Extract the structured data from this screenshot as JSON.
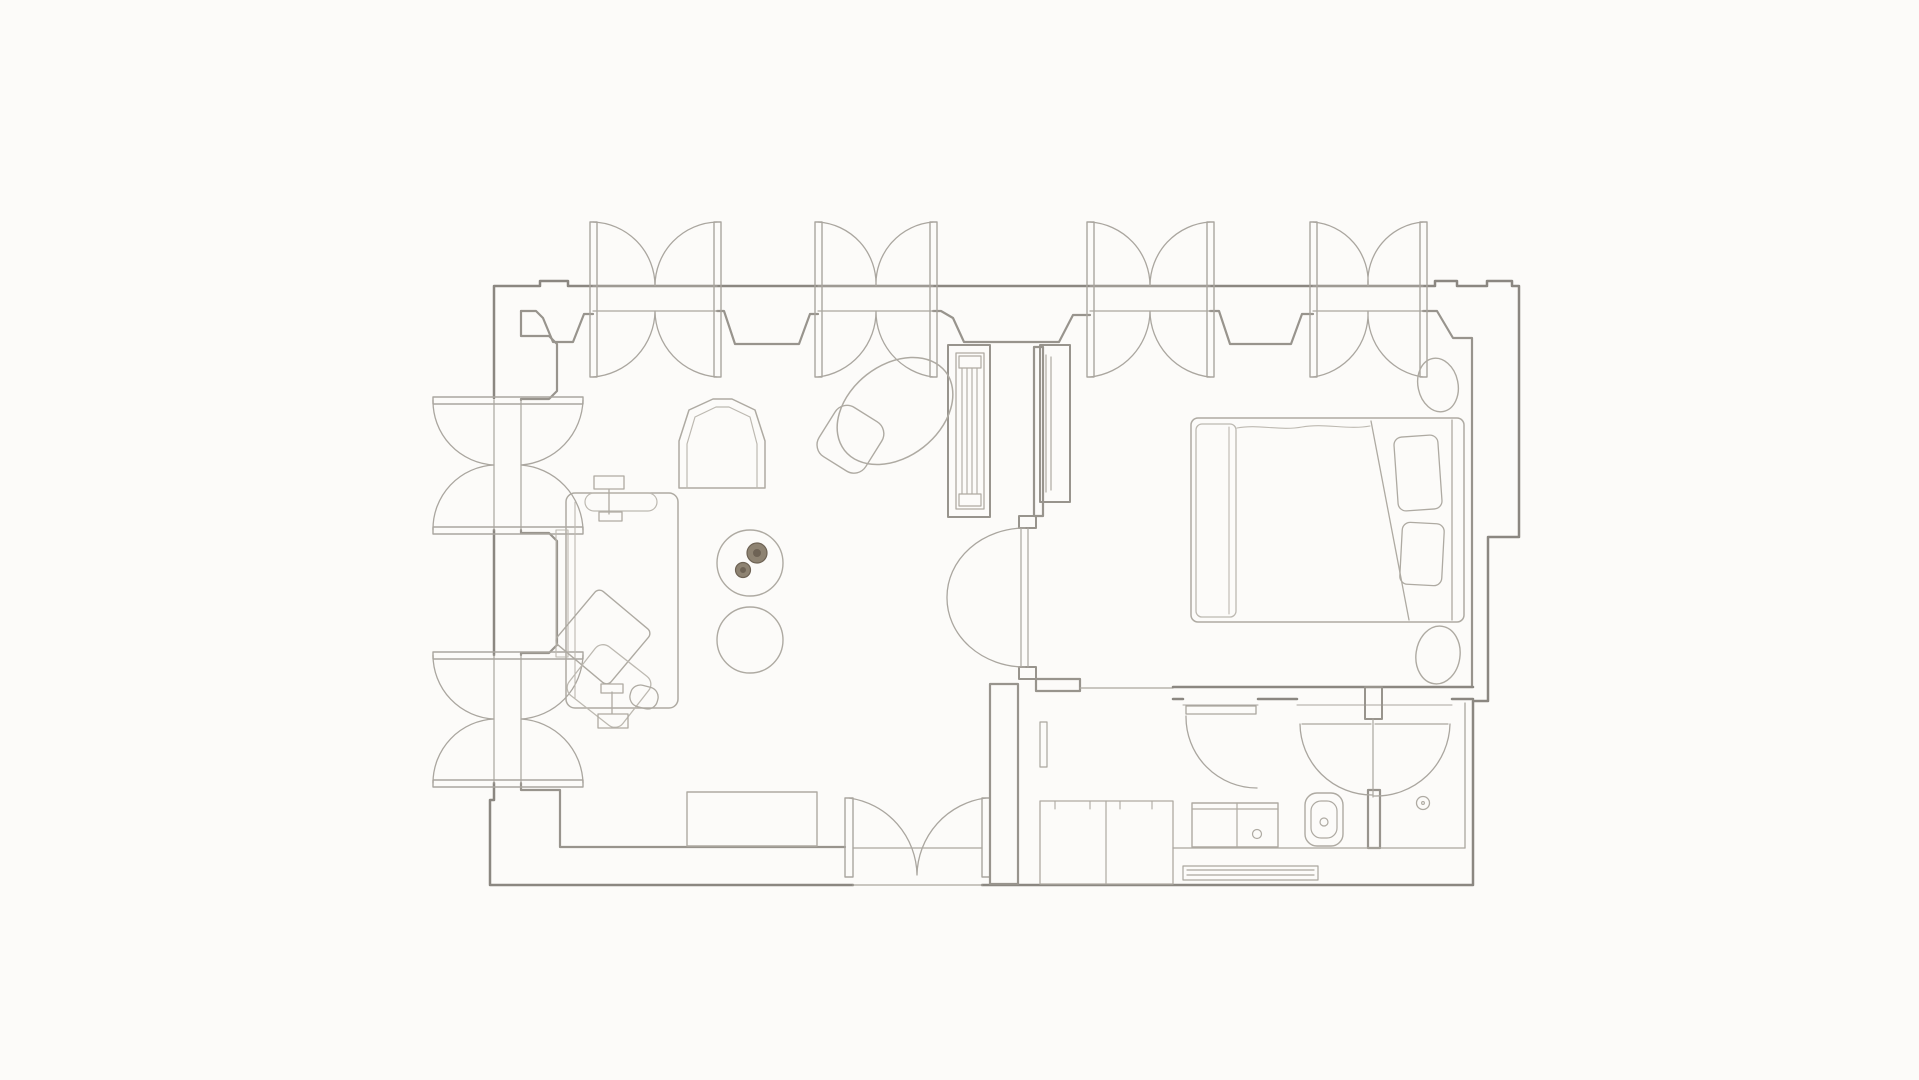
{
  "canvas": {
    "width": 1919,
    "height": 1080,
    "background": "#fcfbf9"
  },
  "palette": {
    "wall": "#8b8781",
    "wall_mid": "#98948d",
    "wall_light": "#aaa69f",
    "furniture": "#aeaaa2",
    "furniture_light": "#bdb9b1",
    "flower_fill": "#8e8372",
    "flower_dark": "#6e6355",
    "white": "#fcfbf9"
  },
  "shapes": [
    {
      "n": "outer-wall",
      "t": "path",
      "d": "M 494,398 V 286 H 540 V 281 H 568 V 286 H 1435 V 281 H 1457 V 286 H 1487 V 281 H 1512 V 286 H 1519 V 537 H 1488 V 701 H 1473 V 885 H 982 M 853,885 H 490 V 800 H 494 V 783 M 494,530 V 655",
      "s": "wall",
      "w": 2.5
    },
    {
      "n": "inner-wall-top",
      "t": "path",
      "d": "M 521,311 H 536 L 543,318 L 553,342 H 573 L 584,314 H 593 M 717,311 H 724 L 735,344 H 799 L 810,314 H 818 M 933,311 H 941 L 953,318 L 964,342 H 1059 L 1073,315 H 1090 M 1210,311 H 1219 L 1230,344 H 1291 L 1302,314 H 1313 M 1423,311 H 1437 L 1453,338 H 1472 V 687",
      "s": "wall_mid",
      "w": 2.2
    },
    {
      "n": "inner-wall-left",
      "t": "path",
      "d": "M 521,311 V 336 H 549 L 557,344 V 391 L 549,399 H 521 V 400 M 521,530 V 533 H 549 L 557,541 V 645 L 549,653 H 521 V 655",
      "s": "wall_mid",
      "w": 2.2
    },
    {
      "n": "inner-wall-bottom",
      "t": "path",
      "d": "M 521,783 V 790 H 560 V 847 H 845",
      "s": "wall_mid",
      "w": 2.2
    },
    {
      "n": "threshold-outer-line",
      "t": "path",
      "d": "M 853,885 H 982",
      "s": "wall_light",
      "w": 1.3
    },
    {
      "n": "threshold-inner-line",
      "t": "path",
      "d": "M 853,848 H 982",
      "s": "wall_light",
      "w": 1.3
    },
    {
      "n": "window-1-leaf-left",
      "t": "rect",
      "x": 590,
      "y": 222,
      "w2": 7,
      "h": 155,
      "s": "wall_light",
      "w": 1.4
    },
    {
      "n": "window-1-leaf-right",
      "t": "rect",
      "x": 714,
      "y": 222,
      "w2": 7,
      "h": 155,
      "s": "wall_light",
      "w": 1.4
    },
    {
      "n": "window-1-glazing",
      "t": "path",
      "d": "M 593,286 H 717 M 593,311 H 717",
      "s": "wall_light",
      "w": 1.2
    },
    {
      "n": "window-1-swing-arcs",
      "t": "path",
      "d": "M 593,222 A 64 64 0 0 1 655,286 M 717,222 A 64 64 0 0 0 655,286 M 593,377 A 67 67 0 0 0 655,311 M 717,377 A 67 67 0 0 1 655,311",
      "s": "wall_light",
      "w": 1.3
    },
    {
      "n": "window-2-leaf-left",
      "t": "rect",
      "x": 815,
      "y": 222,
      "w2": 7,
      "h": 155,
      "s": "wall_light",
      "w": 1.4
    },
    {
      "n": "window-2-leaf-right",
      "t": "rect",
      "x": 930,
      "y": 222,
      "w2": 7,
      "h": 155,
      "s": "wall_light",
      "w": 1.4
    },
    {
      "n": "window-2-glazing",
      "t": "path",
      "d": "M 818,286 H 933 M 818,311 H 933",
      "s": "wall_light",
      "w": 1.2
    },
    {
      "n": "window-2-swing-arcs",
      "t": "path",
      "d": "M 818,222 A 62 62 0 0 1 876,286 M 933,222 A 62 62 0 0 0 876,286 M 818,377 A 66 66 0 0 0 876,311 M 933,377 A 66 66 0 0 1 876,311",
      "s": "wall_light",
      "w": 1.3
    },
    {
      "n": "window-3-leaf-left",
      "t": "rect",
      "x": 1087,
      "y": 222,
      "w2": 7,
      "h": 155,
      "s": "wall_light",
      "w": 1.4
    },
    {
      "n": "window-3-leaf-right",
      "t": "rect",
      "x": 1207,
      "y": 222,
      "w2": 7,
      "h": 155,
      "s": "wall_light",
      "w": 1.4
    },
    {
      "n": "window-3-glazing",
      "t": "path",
      "d": "M 1090,286 H 1210 M 1090,311 H 1210",
      "s": "wall_light",
      "w": 1.2
    },
    {
      "n": "window-3-swing-arcs",
      "t": "path",
      "d": "M 1090,222 A 64 64 0 0 1 1150,286 M 1210,222 A 64 64 0 0 0 1150,286 M 1090,377 A 67 67 0 0 0 1150,311 M 1210,377 A 67 67 0 0 1 1150,311",
      "s": "wall_light",
      "w": 1.3
    },
    {
      "n": "window-4-leaf-left",
      "t": "rect",
      "x": 1310,
      "y": 222,
      "w2": 7,
      "h": 155,
      "s": "wall_light",
      "w": 1.4
    },
    {
      "n": "window-4-leaf-right",
      "t": "rect",
      "x": 1420,
      "y": 222,
      "w2": 7,
      "h": 155,
      "s": "wall_light",
      "w": 1.4
    },
    {
      "n": "window-4-glazing",
      "t": "path",
      "d": "M 1313,286 H 1423 M 1313,311 H 1423",
      "s": "wall_light",
      "w": 1.2
    },
    {
      "n": "window-4-swing-arcs",
      "t": "path",
      "d": "M 1313,222 A 60 60 0 0 1 1368,286 M 1423,222 A 60 60 0 0 0 1368,286 M 1313,377 A 64 64 0 0 0 1368,311 M 1423,377 A 64 64 0 0 1 1368,311",
      "s": "wall_light",
      "w": 1.3
    },
    {
      "n": "left-window-1-leaf-top",
      "t": "rect",
      "x": 433,
      "y": 397,
      "w2": 150,
      "h": 7,
      "s": "wall_light",
      "w": 1.4
    },
    {
      "n": "left-window-1-leaf-bottom",
      "t": "rect",
      "x": 433,
      "y": 527,
      "w2": 150,
      "h": 7,
      "s": "wall_light",
      "w": 1.4
    },
    {
      "n": "left-window-1-glazing",
      "t": "path",
      "d": "M 494,400 V 530 M 521,400 V 530",
      "s": "wall_light",
      "w": 1.2
    },
    {
      "n": "left-window-1-swing-arcs",
      "t": "path",
      "d": "M 433,400 A 64 64 0 0 0 494,465 M 433,530 A 64 64 0 0 1 494,465 M 583,400 A 67 67 0 0 1 521,465 M 583,530 A 67 67 0 0 0 521,465",
      "s": "wall_light",
      "w": 1.3
    },
    {
      "n": "left-window-2-leaf-top",
      "t": "rect",
      "x": 433,
      "y": 652,
      "w2": 150,
      "h": 7,
      "s": "wall_light",
      "w": 1.4
    },
    {
      "n": "left-window-2-leaf-bottom",
      "t": "rect",
      "x": 433,
      "y": 780,
      "w2": 150,
      "h": 7,
      "s": "wall_light",
      "w": 1.4
    },
    {
      "n": "left-window-2-glazing",
      "t": "path",
      "d": "M 494,655 V 783 M 521,655 V 783",
      "s": "wall_light",
      "w": 1.2
    },
    {
      "n": "left-window-2-swing-arcs",
      "t": "path",
      "d": "M 433,655 A 64 64 0 0 0 494,719 M 433,783 A 64 64 0 0 1 494,719 M 583,655 A 66 66 0 0 1 521,719 M 583,783 A 66 66 0 0 0 521,719",
      "s": "wall_light",
      "w": 1.3
    },
    {
      "n": "entry-door-leaf-left",
      "t": "rect",
      "x": 845,
      "y": 798,
      "w2": 8,
      "h": 79,
      "s": "wall_light",
      "w": 1.4
    },
    {
      "n": "entry-door-leaf-right",
      "t": "rect",
      "x": 982,
      "y": 798,
      "w2": 8,
      "h": 79,
      "s": "wall_light",
      "w": 1.4
    },
    {
      "n": "entry-door-swing-arcs",
      "t": "path",
      "d": "M 849,798 A 79 79 0 0 1 917,875 M 986,798 A 79 79 0 0 0 917,875",
      "s": "wall_light",
      "w": 1.3
    },
    {
      "n": "partition-wall-stem",
      "t": "rect",
      "x": 1034,
      "y": 347,
      "w2": 9,
      "h": 169,
      "s": "wall_mid",
      "w": 2.2
    },
    {
      "n": "partition-door-jamb-top",
      "t": "rect",
      "x": 1019,
      "y": 516,
      "w2": 17,
      "h": 12,
      "s": "wall_mid",
      "w": 2
    },
    {
      "n": "partition-door-jamb-bottom",
      "t": "rect",
      "x": 1019,
      "y": 667,
      "w2": 17,
      "h": 12,
      "s": "wall_mid",
      "w": 2
    },
    {
      "n": "partition-door-leaf-line",
      "t": "path",
      "d": "M 1021,528 V 667 M 1028,528 V 667",
      "s": "wall_light",
      "w": 1.2
    },
    {
      "n": "partition-door-swing-arcs",
      "t": "path",
      "d": "M 1025,528 A 78 69 0 0 0 947,597 M 947,597 A 78 69 0 0 0 1025,667",
      "s": "wall_light",
      "w": 1.3
    },
    {
      "n": "closet-living-outer",
      "t": "rect",
      "x": 948,
      "y": 345,
      "w2": 42,
      "h": 172,
      "s": "wall_mid",
      "w": 2
    },
    {
      "n": "closet-living-inner",
      "t": "rect",
      "x": 956,
      "y": 353,
      "w2": 28,
      "h": 156,
      "s": "furniture",
      "w": 1.3
    },
    {
      "n": "closet-living-rail-caps",
      "t": "path",
      "d": "M 959,356 H 981 V 368 H 959 Z M 959,494 H 981 V 506 H 959 Z",
      "s": "furniture",
      "w": 1.2
    },
    {
      "n": "closet-living-louvers",
      "t": "path",
      "d": "M 962,368 V 494 M 967,368 V 494 M 972,368 V 494 M 977,368 V 494",
      "s": "furniture",
      "w": 1.1
    },
    {
      "n": "closet-bedroom-outer",
      "t": "rect",
      "x": 1040,
      "y": 345,
      "w2": 30,
      "h": 157,
      "s": "wall_mid",
      "w": 2
    },
    {
      "n": "closet-bedroom-inner",
      "t": "path",
      "d": "M 1046,355 V 492 M 1051,357 V 490",
      "s": "furniture",
      "w": 1.2
    },
    {
      "n": "hall-west-wall",
      "t": "rect",
      "x": 990,
      "y": 684,
      "w2": 28,
      "h": 200,
      "s": "wall_mid",
      "w": 2.2
    },
    {
      "n": "hall-wall-stub",
      "t": "rect",
      "x": 1036,
      "y": 679,
      "w2": 44,
      "h": 12,
      "s": "wall_mid",
      "w": 2.2
    },
    {
      "n": "hall-north-line",
      "t": "path",
      "d": "M 1080,688 H 1173",
      "s": "wall_light",
      "w": 1.2
    },
    {
      "n": "hall-wall-mirror",
      "t": "rect",
      "x": 1040,
      "y": 722,
      "w2": 7,
      "h": 45,
      "s": "wall_light",
      "w": 1.2
    },
    {
      "n": "hall-closet",
      "t": "rect",
      "x": 1040,
      "y": 801,
      "w2": 133,
      "h": 83,
      "s": "furniture",
      "w": 1.3
    },
    {
      "n": "hall-closet-divider",
      "t": "path",
      "d": "M 1106,801 V 884",
      "s": "furniture",
      "w": 1.2
    },
    {
      "n": "hall-closet-hinge-ticks",
      "t": "path",
      "d": "M 1055,801 V 809 M 1090,801 V 809 M 1120,801 V 809 M 1152,801 V 809",
      "s": "furniture",
      "w": 1.1
    },
    {
      "n": "bathroom-north-wall",
      "t": "path",
      "d": "M 1173,687 H 1473 M 1173,699 H 1183 M 1258,699 H 1297 M 1452,699 H 1473",
      "s": "wall",
      "w": 2.5
    },
    {
      "n": "bathroom-door-head-lines",
      "t": "path",
      "d": "M 1183,705 H 1258 M 1297,705 H 1452",
      "s": "wall_light",
      "w": 1.1
    },
    {
      "n": "bathroom-divider-nub",
      "t": "rect",
      "x": 1365,
      "y": 687,
      "w2": 17,
      "h": 32,
      "s": "wall_mid",
      "w": 2
    },
    {
      "n": "bathroom-divider-wall",
      "t": "rect",
      "x": 1368,
      "y": 790,
      "w2": 12,
      "h": 58,
      "s": "wall_mid",
      "w": 2.2
    },
    {
      "n": "bathroom-east-wall-line",
      "t": "path",
      "d": "M 1465,703 V 848",
      "s": "wall_light",
      "w": 1.3
    },
    {
      "n": "bathroom-floor-line",
      "t": "path",
      "d": "M 1173,848 H 1465",
      "s": "wall_light",
      "w": 1.3
    },
    {
      "n": "bathroom-door-left-leaf",
      "t": "rect",
      "x": 1186,
      "y": 706,
      "w2": 70,
      "h": 8,
      "s": "wall_light",
      "w": 1.3
    },
    {
      "n": "bathroom-door-left-swing-arc",
      "t": "path",
      "d": "M 1186,716 A 71 71 0 0 0 1257,788",
      "s": "wall_light",
      "w": 1.3
    },
    {
      "n": "shower-double-door-leaf-lines",
      "t": "path",
      "d": "M 1302,724 H 1371 M 1375,724 H 1448 M 1373,719 V 797",
      "s": "wall_light",
      "w": 1.2
    },
    {
      "n": "shower-double-door-swing-arcs",
      "t": "path",
      "d": "M 1300,724 A 72 72 0 0 0 1372,795 M 1450,724 A 74 74 0 0 1 1374,796",
      "s": "wall_light",
      "w": 1.3
    },
    {
      "n": "vanity-counter",
      "t": "rect",
      "x": 1192,
      "y": 803,
      "w2": 86,
      "h": 44,
      "s": "furniture",
      "w": 1.4
    },
    {
      "n": "vanity-counter-edge",
      "t": "path",
      "d": "M 1192,809 H 1278 M 1237,803 V 847",
      "s": "furniture",
      "w": 1.2
    },
    {
      "n": "vanity-basin-drain",
      "t": "circle",
      "cx": 1257,
      "cy": 834,
      "r": 4.5,
      "s": "furniture",
      "w": 1.2
    },
    {
      "n": "toilet-bowl-outer",
      "t": "rect",
      "x": 1305,
      "y": 793,
      "w2": 38,
      "h": 53,
      "rx": 12,
      "s": "furniture",
      "w": 1.4
    },
    {
      "n": "toilet-bowl-inner",
      "t": "rect",
      "x": 1311,
      "y": 801,
      "w2": 26,
      "h": 37,
      "rx": 10,
      "s": "furniture",
      "w": 1.2
    },
    {
      "n": "toilet-flush-button",
      "t": "circle",
      "cx": 1324,
      "cy": 822,
      "r": 4,
      "s": "furniture",
      "w": 1.2
    },
    {
      "n": "shower-drain",
      "t": "circle",
      "cx": 1423,
      "cy": 803,
      "r": 6.5,
      "s": "furniture",
      "w": 1.3
    },
    {
      "n": "shower-drain-dot",
      "t": "circle",
      "cx": 1423,
      "cy": 803,
      "r": 1.4,
      "s": "furniture",
      "w": 1.1
    },
    {
      "n": "bathroom-wall-radiator",
      "t": "path",
      "d": "M 1183,866 H 1318 V 880 H 1183 Z M 1187,870 H 1314 M 1187,875 H 1314",
      "s": "wall_light",
      "w": 1.2
    },
    {
      "n": "bed-mattress",
      "t": "rect",
      "x": 1191,
      "y": 418,
      "w2": 273,
      "h": 204,
      "rx": 7,
      "s": "furniture",
      "w": 1.5
    },
    {
      "n": "bed-headboard-line",
      "t": "path",
      "d": "M 1452,420 V 620",
      "s": "furniture",
      "w": 1.3
    },
    {
      "n": "bed-foot-blanket",
      "t": "rect",
      "x": 1196,
      "y": 424,
      "w2": 40,
      "h": 193,
      "rx": 6,
      "s": "furniture_light",
      "w": 1.3
    },
    {
      "n": "bed-foot-blanket-fold",
      "t": "path",
      "d": "M 1229,427 V 614",
      "s": "furniture_light",
      "w": 1.1
    },
    {
      "n": "bed-duvet-edge-wavy",
      "t": "path",
      "d": "M 1237,428 C 1258,424 1280,431 1302,427 C 1324,423 1348,430 1370,426",
      "s": "furniture_light",
      "w": 1.1
    },
    {
      "n": "bed-duvet-diagonal-fold",
      "t": "path",
      "d": "M 1371,421 L 1409,620",
      "s": "furniture",
      "w": 1.3
    },
    {
      "n": "bed-pillow-1",
      "t": "rect",
      "x": 1396,
      "y": 436,
      "w2": 44,
      "h": 74,
      "rx": 8,
      "s": "furniture",
      "w": 1.3,
      "tr": "rotate(-4 1418 473)"
    },
    {
      "n": "bed-pillow-2",
      "t": "rect",
      "x": 1401,
      "y": 523,
      "w2": 42,
      "h": 62,
      "rx": 8,
      "s": "furniture",
      "w": 1.3,
      "tr": "rotate(3 1422 554)"
    },
    {
      "n": "bedside-pouf-north",
      "t": "ellipse",
      "cx": 1438,
      "cy": 385,
      "rx": 20,
      "ry": 27,
      "s": "furniture",
      "w": 1.4,
      "tr": "rotate(-12 1438 385)"
    },
    {
      "n": "bedside-pouf-south",
      "t": "ellipse",
      "cx": 1438,
      "cy": 655,
      "rx": 22,
      "ry": 29,
      "s": "furniture",
      "w": 1.4,
      "tr": "rotate(8 1438 655)"
    },
    {
      "n": "arch-armchair-outer",
      "t": "path",
      "d": "M 679,488 V 441 L 689,410 L 713,399 H 732 L 755,410 L 765,441 V 488 Z",
      "s": "furniture",
      "w": 1.5
    },
    {
      "n": "arch-armchair-inner",
      "t": "path",
      "d": "M 687,488 V 444 L 695,417 L 716,407 H 729 L 750,417 L 757,444 V 488",
      "s": "furniture_light",
      "w": 1.2
    },
    {
      "n": "oval-dining-table",
      "t": "ellipse",
      "cx": 895,
      "cy": 411,
      "rx": 64,
      "ry": 46,
      "s": "furniture",
      "w": 1.5,
      "tr": "rotate(-38 895 411)"
    },
    {
      "n": "oval-table-chair",
      "t": "rect",
      "x": 823,
      "y": 410,
      "w2": 55,
      "h": 58,
      "rx": 14,
      "s": "furniture",
      "w": 1.4,
      "tr": "rotate(32 850 439)"
    },
    {
      "n": "round-side-table-flowers",
      "t": "circle",
      "cx": 750,
      "cy": 563,
      "r": 33,
      "s": "furniture",
      "w": 1.4
    },
    {
      "n": "round-side-table-plain",
      "t": "circle",
      "cx": 750,
      "cy": 640,
      "r": 33,
      "s": "furniture",
      "w": 1.4
    },
    {
      "n": "flower-rosette-large",
      "t": "circle",
      "cx": 757,
      "cy": 553,
      "r": 10,
      "s": "flower_dark",
      "w": 1.2,
      "f": "flower_fill"
    },
    {
      "n": "flower-rosette-large-core",
      "t": "circle",
      "cx": 757,
      "cy": 553,
      "r": 3.5,
      "s": "flower_dark",
      "w": 1,
      "f": "flower_dark"
    },
    {
      "n": "flower-rosette-small",
      "t": "circle",
      "cx": 743,
      "cy": 570,
      "r": 7.5,
      "s": "flower_dark",
      "w": 1.2,
      "f": "flower_fill"
    },
    {
      "n": "flower-rosette-small-core",
      "t": "circle",
      "cx": 743,
      "cy": 570,
      "r": 2.5,
      "s": "flower_dark",
      "w": 1,
      "f": "flower_dark"
    },
    {
      "n": "sofa-body",
      "t": "rect",
      "x": 566,
      "y": 493,
      "w2": 112,
      "h": 215,
      "rx": 9,
      "s": "furniture",
      "w": 1.5
    },
    {
      "n": "sofa-back-line",
      "t": "path",
      "d": "M 575,502 V 698",
      "s": "furniture_light",
      "w": 1.1
    },
    {
      "n": "sofa-armrest-bolster",
      "t": "rect",
      "x": 585,
      "y": 493,
      "w2": 72,
      "h": 18,
      "rx": 9,
      "s": "furniture_light",
      "w": 1.2
    },
    {
      "n": "sofa-console-strip",
      "t": "rect",
      "x": 556,
      "y": 530,
      "w2": 12,
      "h": 127,
      "s": "furniture_light",
      "w": 1.1
    },
    {
      "n": "sofa-cushion-upper",
      "t": "rect",
      "x": 568,
      "y": 602,
      "w2": 70,
      "h": 70,
      "rx": 6,
      "s": "furniture",
      "w": 1.4,
      "tr": "rotate(40 603 637)"
    },
    {
      "n": "sofa-cushion-lower",
      "t": "rect",
      "x": 575,
      "y": 655,
      "w2": 68,
      "h": 62,
      "rx": 10,
      "s": "furniture_light",
      "w": 1.3,
      "tr": "rotate(38 609 686)"
    },
    {
      "n": "sofa-ottoman",
      "t": "rect",
      "x": 630,
      "y": 686,
      "w2": 28,
      "h": 22,
      "rx": 10,
      "s": "furniture",
      "w": 1.3,
      "tr": "rotate(15 644 697)"
    },
    {
      "n": "desk-chair-north",
      "t": "path",
      "d": "M 594,476 H 624 V 489 H 594 Z M 609,489 V 514 M 599,512 H 622 V 521 H 599 Z",
      "s": "furniture",
      "w": 1.3
    },
    {
      "n": "desk-chair-south",
      "t": "path",
      "d": "M 598,714 H 628 V 728 H 598 Z M 612,714 V 692 M 601,684 H 623 V 693 H 601 Z",
      "s": "furniture",
      "w": 1.3
    },
    {
      "n": "sideboard-bottom-wall",
      "t": "rect",
      "x": 687,
      "y": 792,
      "w2": 130,
      "h": 54,
      "s": "furniture",
      "w": 1.4
    }
  ]
}
